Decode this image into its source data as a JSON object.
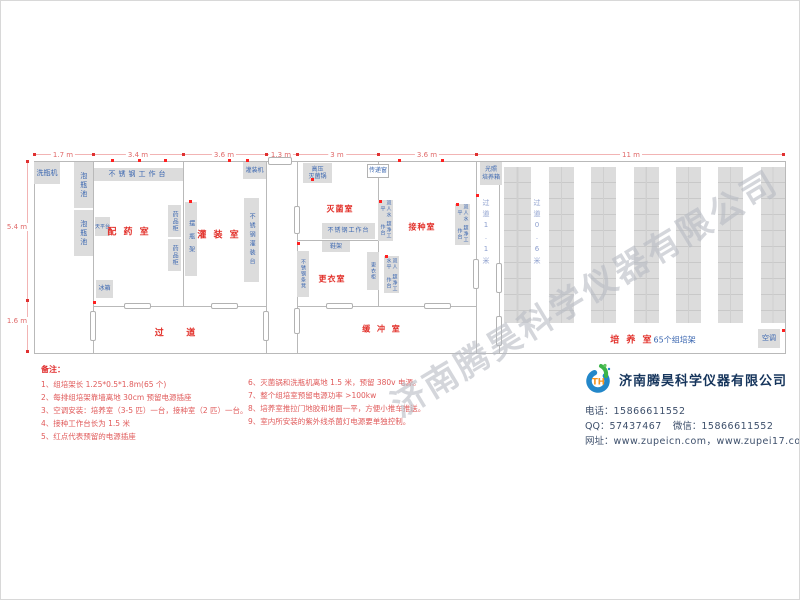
{
  "watermark": "济南腾昊科学仪器有限公司",
  "plan": {
    "dims_top": [
      "1.7 m",
      "3.4 m",
      "3.6 m",
      "1.3 m",
      "3 m",
      "3.6 m",
      "11 m"
    ],
    "dims_left": [
      "5.4 m",
      "1.6 m"
    ],
    "rooms": {
      "prep": "配 药 室",
      "filling": "灌 装 室",
      "sterilize": "灭菌室",
      "changing": "更衣室",
      "inoculation": "接种室",
      "corridor": "过    道",
      "buffer": "缓 冲 室",
      "culture": "培 养 室",
      "culture_note": "65个组培架"
    },
    "corridors": {
      "c11": "过道1.1米",
      "c06": "过道0.6米"
    },
    "equipment": {
      "washer": "洗瓶机",
      "soak_pool": "泡瓶池",
      "ss_worktop": "不锈钢工作台",
      "balance": "天平台",
      "medicine_cabinet": "药品柜",
      "fridge": "冰箱",
      "bottle_rack": "摆瓶架",
      "filling_machine": "灌装机",
      "ss_filling_table": "不锈钢灌装台",
      "autoclave_l1": "高压",
      "autoclave_l2": "灭菌锅",
      "pass_window": "传递窗",
      "shoe_rack": "鞋架",
      "ss_bench": "不锈钢条凳",
      "locker": "更衣柜",
      "clean_bench_l1": "双人水平",
      "clean_bench_l2": "超净工作台",
      "incubator_l1": "光照",
      "incubator_l2": "培养箱",
      "ac": "空调"
    }
  },
  "notes": {
    "title": "备注：",
    "left": [
      "1、组培架长 1.25*0.5*1.8m(65 个)",
      "2、每排组培架靠墙离地 30cm 预留电源插座",
      "3、空调安装：培养室（3-5 匹）一台，接种室（2 匹）一台。",
      "4、接种工作台长为 1.5 米",
      "5、红点代表预留的电源插座"
    ],
    "right": [
      "6、灭菌锅和洗瓶机离地 1.5 米，预留 380v 电源。",
      "7、整个组培室预留电源功率 >100kw",
      "8、培养室推拉门地胶和地面一平，方便小推车推送。",
      "9、室内所安装的紫外线杀菌灯电源要单独控制。"
    ]
  },
  "company": {
    "name": "济南腾昊科学仪器有限公司",
    "phone_label": "电话：",
    "phone": "15866611552",
    "qq_label": "QQ：",
    "qq": "57437467",
    "wechat_label": "微信：",
    "wechat": "15866611552",
    "web_label": "网址：",
    "web": "www.zupeicn.com，www.zupei17.com"
  }
}
